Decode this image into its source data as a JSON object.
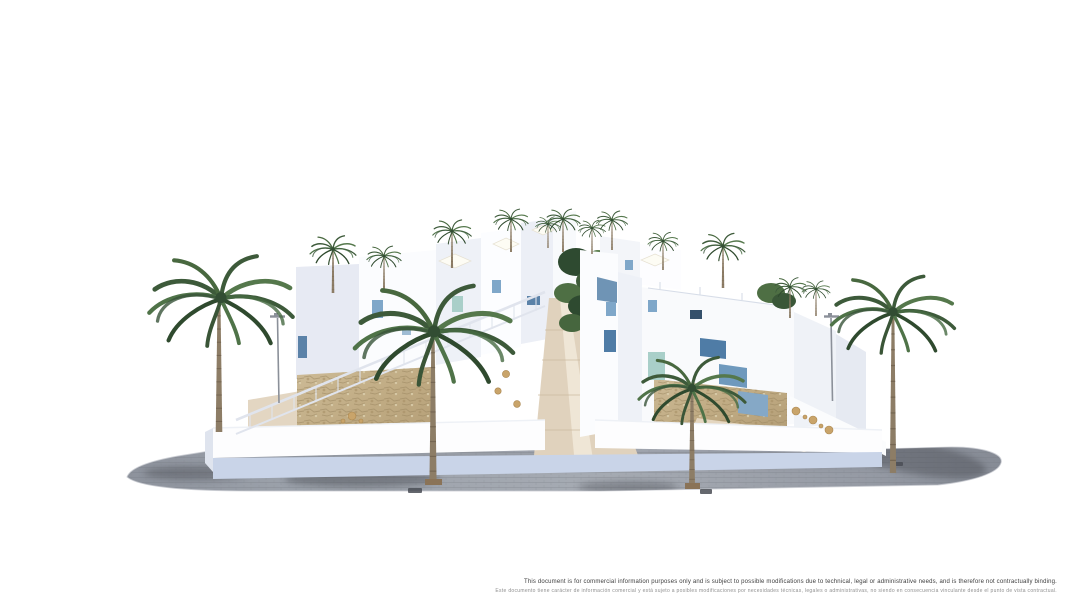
{
  "disclaimer": {
    "line_en": "This document is for commercial information purposes only and is subject to possible modifications due to technical, legal or administrative needs, and is therefore not contractually binding.",
    "line_es": "Este documento tiene carácter de información comercial y está sujeto a posibles modificaciones por necesidades técnicas, legales o administrativas, no siendo en consecuencia vinculante desde el punto de vista contractual."
  },
  "palette": {
    "background": "#ffffff",
    "pavement_gray": "#9aa0a9",
    "wall_white": "#fafbfd",
    "wall_shade": "#e7eaf3",
    "base_band_blue": "#c9d4e8",
    "stone_tan": "#c7b38d",
    "terrace_sand": "#e2d4bf",
    "accent_steel_blue": "#4f7ca6",
    "accent_light_blue": "#7fa7c9",
    "accent_teal": "#a9cfc9",
    "palm_green": "#3d5a3a",
    "trunk_brown": "#8d7d66"
  }
}
